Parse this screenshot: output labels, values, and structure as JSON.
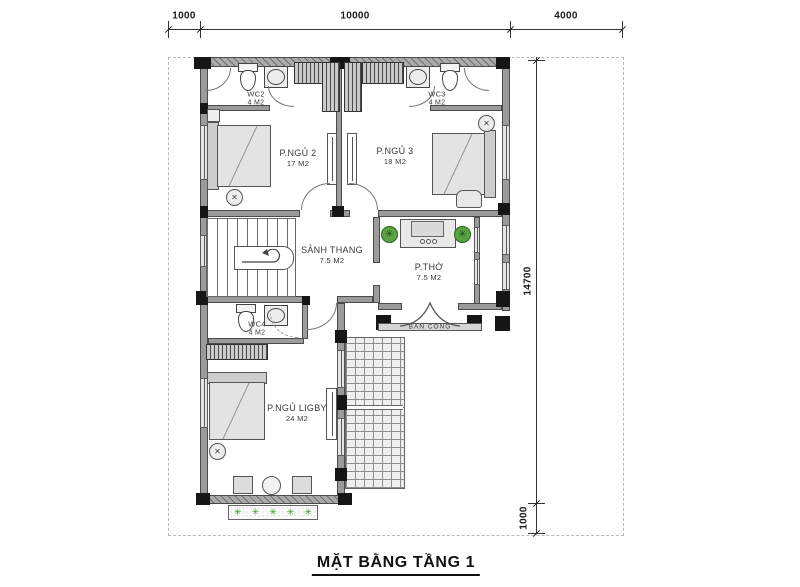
{
  "title": "MẶT BẰNG TẦNG 1",
  "dimensions": {
    "top": [
      "1000",
      "10000",
      "4000"
    ],
    "right": [
      "14700",
      "1000"
    ]
  },
  "rooms": {
    "wc2": {
      "name": "WC2",
      "area": "4 M2"
    },
    "wc3": {
      "name": "WC3",
      "area": "4 M2"
    },
    "bedroom2": {
      "name": "P.NGỦ 2",
      "area": "17 M2"
    },
    "bedroom3": {
      "name": "P.NGỦ 3",
      "area": "18 M2"
    },
    "stair_hall": {
      "name": "SẢNH THANG",
      "area": "7.5 M2"
    },
    "worship_room": {
      "name": "P.THỜ",
      "area": "7.5 M2"
    },
    "wc4": {
      "name": "WC4",
      "area": "4 M2"
    },
    "balcony": {
      "name": "BAN CÔNG"
    },
    "bedroom_master": {
      "name": "P.NGỦ LIGBY",
      "area": "24 M2"
    }
  },
  "icons": {
    "plant_glyph": "✳",
    "fan_glyph": "✕"
  },
  "colors": {
    "wall_gray": "#9b9b9b",
    "column_black": "#161616",
    "window_gray": "#e4e4e4",
    "plant_green": "#5aa244",
    "line_dark": "#2b2b2b",
    "boundary_dash": "#b9b9b9"
  }
}
